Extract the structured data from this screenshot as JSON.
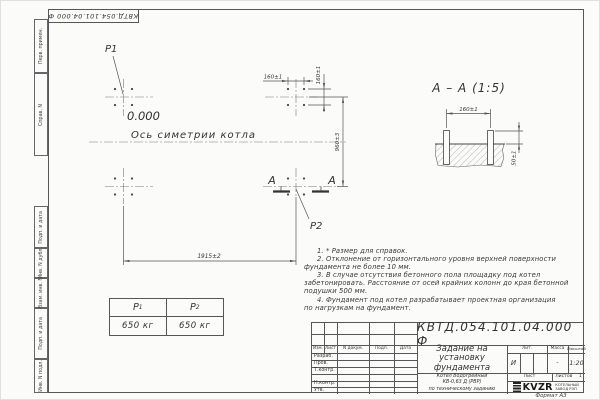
{
  "sheet": {
    "corner_ref": "КВТД.054.101.04.000  Ф",
    "format_label": "Формат А3",
    "side_strips": [
      "Перв. примен.",
      "Справ. N",
      "Подп. и дата",
      "Инв. N дубл.",
      "Взам. инв. N",
      "Подп. и дата",
      "Инв. N подл."
    ]
  },
  "plan": {
    "p1": "P1",
    "p2": "P2",
    "elevation": "0.000",
    "axis_label": "Ось симетрии котла",
    "dim_bolt_x": "160±1",
    "dim_bolt_y": "160±1",
    "dim_height": "960±3",
    "dim_length": "1915±2",
    "section_letter_left": "А",
    "section_letter_right": "А"
  },
  "section": {
    "title": "А – А (1:5)",
    "dim_spacing": "160±1",
    "dim_protrusion": "50±1"
  },
  "load_table": {
    "col1_header": "P",
    "col1_sub": "1",
    "col2_header": "P",
    "col2_sub": "2",
    "col1_value": "650 кг",
    "col2_value": "650 кг"
  },
  "notes": {
    "lines": [
      "1. * Размер для справок.",
      "2. Отклонение от горизонтального уровня верхней поверхности",
      "фундамента не более 10 мм.",
      "3. В случае отсутствия бетонного пола площадку под котел",
      "забетонировать. Расстояние от осей крайних колонн до края бетонной",
      "подушки 500 мм.",
      "4. Фундамент под котел разрабатывает проектная организация",
      "по нагрузкам на фундамент."
    ]
  },
  "title_block": {
    "doc_number": "КВТД.054.101.04.000  Ф",
    "name_lines": [
      "Задание на",
      "установку",
      "фундамента"
    ],
    "product_lines": [
      "Котел Водогрейный",
      "КВ-0,63 Д (РВР)",
      "по техническому заданию"
    ],
    "col_izm": "Изм.",
    "col_list": "Лист",
    "col_doc": "N докум.",
    "col_podp": "Подп.",
    "col_data": "Дата",
    "staff_rows": [
      "Разраб.",
      "Пров.",
      "Т.контр.",
      "",
      "Н.контр.",
      "Утв."
    ],
    "lit_label": "Лит.",
    "lit_value": "И",
    "mass_label": "Масса",
    "mass_value": "-",
    "scale_label": "Масштаб",
    "scale_value": "1:20",
    "sheet_label": "Лист",
    "sheets_label": "Листов",
    "sheets_value": "1",
    "logo_text": "KVZR",
    "logo_caption_1": "КОТЕЛЬНЫЙ",
    "logo_caption_2": "ЗАВОД РЭП"
  }
}
